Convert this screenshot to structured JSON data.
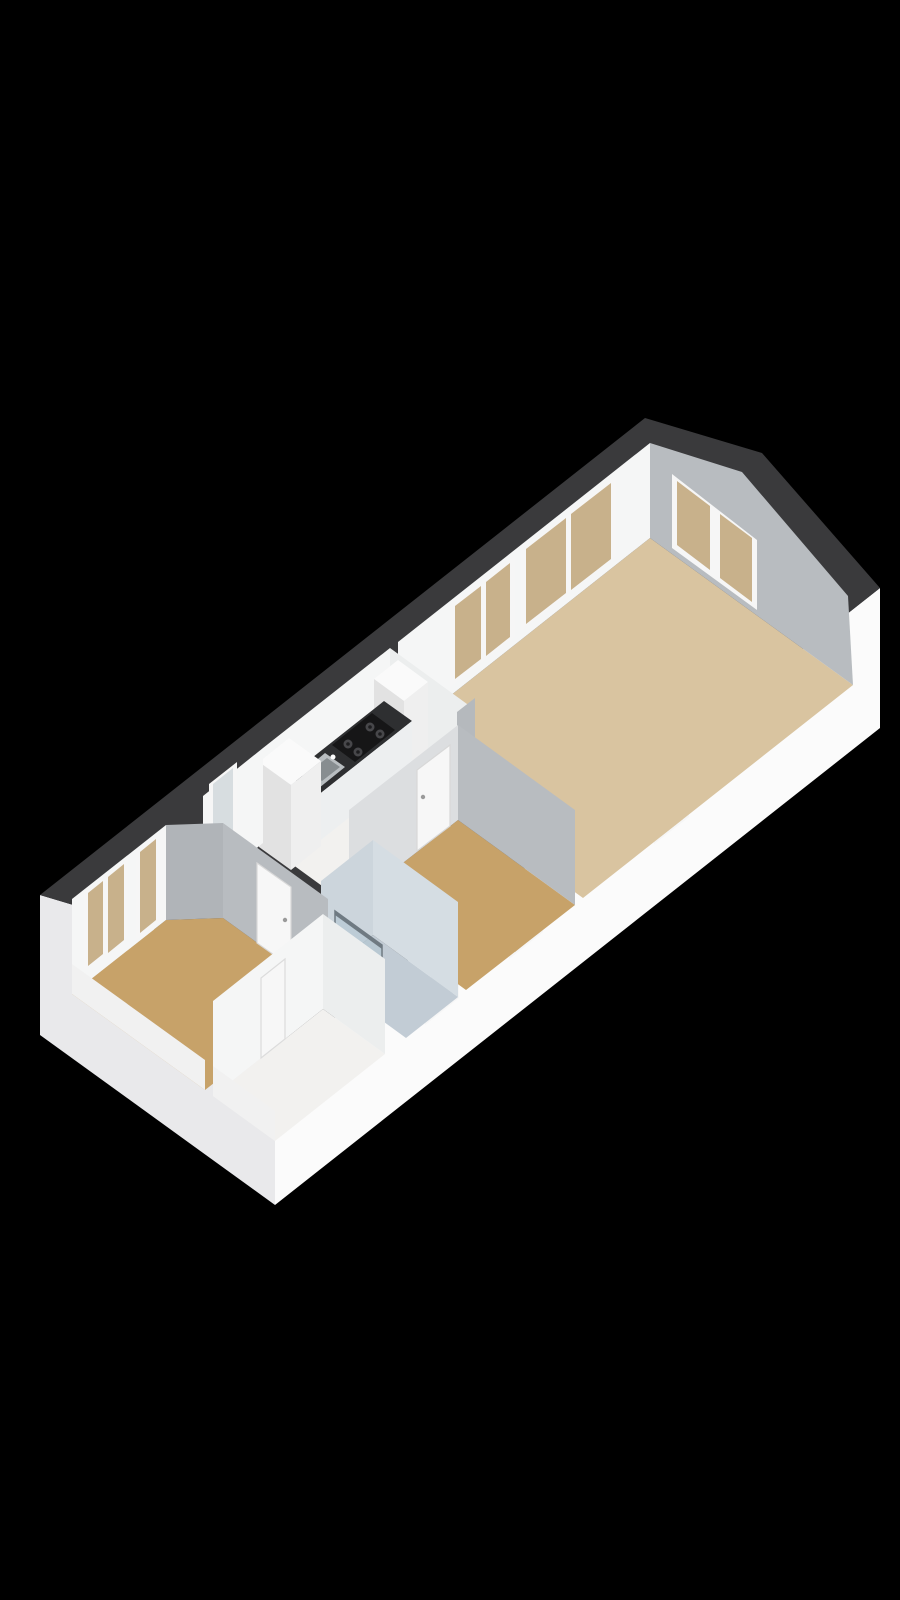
{
  "scene": {
    "description": "3D isometric floor plan of an attic apartment on black background",
    "rooms": [
      "living-room",
      "kitchen",
      "middle-room",
      "hallway",
      "bathroom",
      "bedroom",
      "landing-strip"
    ],
    "fixtures": [
      "kitchen-counter",
      "gas-stove",
      "kitchen-sink",
      "tall-cabinet",
      "fridge-cabinet",
      "toilet",
      "shower-glass",
      "wall-radiator"
    ],
    "window_count": 11,
    "door_count": 3
  },
  "colors": {
    "background": "#000000",
    "plate": "#3a3a3c",
    "ext_wall": "#fbfbfb",
    "ext_end": "#e9e9eb",
    "wall_white": "#f5f6f6",
    "wall_white_dim": "#eceeee",
    "wall_gray": "#b8bcc0",
    "wall_gray_dark": "#b0b4b8",
    "wall_step": "#b5b9bd",
    "wall_light": "#dcdee0",
    "floor_living": "#d9c4a0",
    "floor_tan": "#c7a269",
    "floor_white": "#f2f1ef",
    "floor_bath": "#c2ccd5",
    "bath_wall_nw": "#ccd5dc",
    "bath_wall_ne": "#d5dde3",
    "frame": "#f6f6f6",
    "glass_tan": "#c8b18b",
    "glass_cool": "#d7dde0",
    "counter_top": "#2e2f31",
    "counter_front": "#edeff0",
    "counter_end": "#e0e3e4",
    "stove": "#161617",
    "burner": "#47474a",
    "burner_cap": "#1d1d1f",
    "sink": "#b9bec1",
    "sink_basin": "#878d90",
    "door": "#f7f7f7",
    "door_trim": "#d8d8d8",
    "handle": "#9a9a9a",
    "knee": "#f1f1f1",
    "box_top": "#fafafa",
    "box_se": "#efefef",
    "box_sw": "#e2e2e2",
    "shower_glass": "rgba(174,195,207,0.5)",
    "shower_frame": "#6f7a82",
    "fixture": "#fdfdfd",
    "fixture_shadow": "#cfd6da"
  }
}
